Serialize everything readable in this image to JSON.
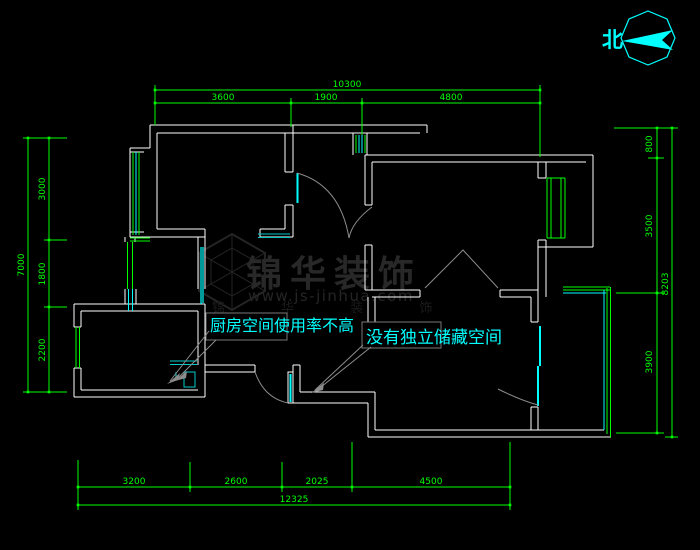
{
  "page": {
    "background": "#000000"
  },
  "compass": {
    "north_label": "北"
  },
  "watermark": {
    "brand": "锦华装饰",
    "url": "www.js-jinhua.com",
    "brand_spaced": "锦 华 装 饰"
  },
  "annotations": {
    "kitchen_note": "厨房空间使用率不高",
    "storage_note": "没有独立储藏空间"
  },
  "dimensions": {
    "top": {
      "seg1": "3600",
      "seg2": "1900",
      "seg3": "4800",
      "overall": "10300"
    },
    "left": {
      "seg1": "3000",
      "seg2": "1800",
      "seg3": "2200",
      "overall": "7000"
    },
    "right": {
      "seg1": "800",
      "seg2": "3500",
      "seg3": "3900",
      "overall": "8203"
    },
    "bottom": {
      "seg1": "3200",
      "seg2": "2600",
      "seg3": "2025",
      "seg4": "4500",
      "overall": "12325"
    }
  },
  "colors": {
    "dimension": "#00ff00",
    "wall": "#ffffff",
    "window": "#00ff00",
    "door": "#00ffff",
    "annotation_text": "#00ffff",
    "leader": "#8c8c8c",
    "compass": "#00ffff",
    "watermark": "#262626"
  }
}
